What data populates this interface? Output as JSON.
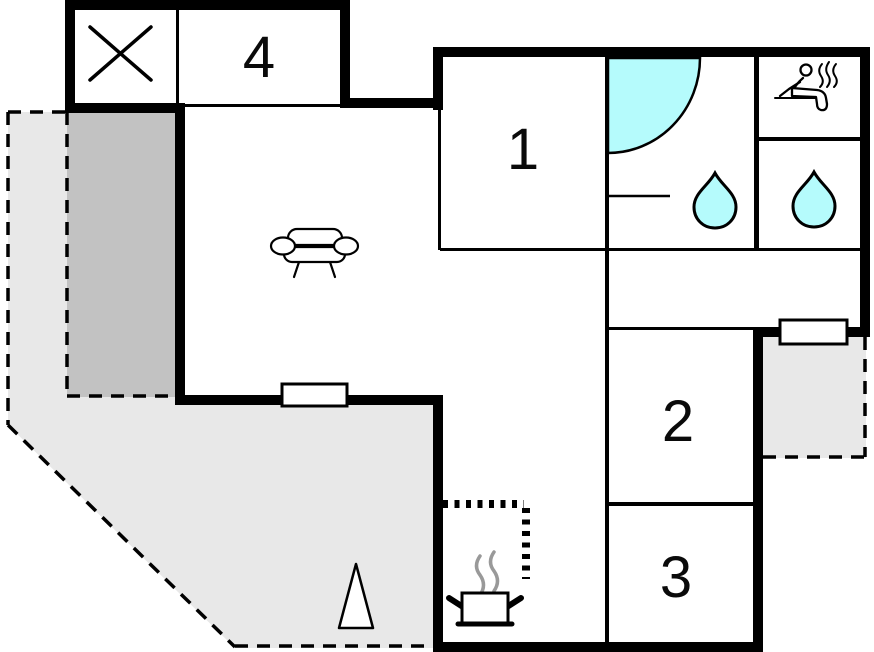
{
  "plan": {
    "type": "floor-plan",
    "rooms": [
      {
        "id": "room-1",
        "label": "1"
      },
      {
        "id": "room-2",
        "label": "2"
      },
      {
        "id": "room-3",
        "label": "3"
      },
      {
        "id": "room-4",
        "label": "4"
      }
    ],
    "colors": {
      "wall": "#000000",
      "water": "#b5fbfc",
      "terrace": "#e8e8e8",
      "veranda": "#c2c2c2",
      "window_fill": "#ffffff",
      "steam_gray": "#999999"
    },
    "icons": [
      "cross-marker-icon",
      "sofa-icon",
      "shower-icon",
      "sink-icon",
      "water-drop-icon",
      "sauna-person-icon",
      "steam-icon",
      "cooking-pot-icon",
      "tree-icon",
      "window"
    ],
    "areas": [
      "terrace-dashed",
      "veranda-dark",
      "balcony-dashed",
      "kitchen-dotted-zone"
    ]
  }
}
